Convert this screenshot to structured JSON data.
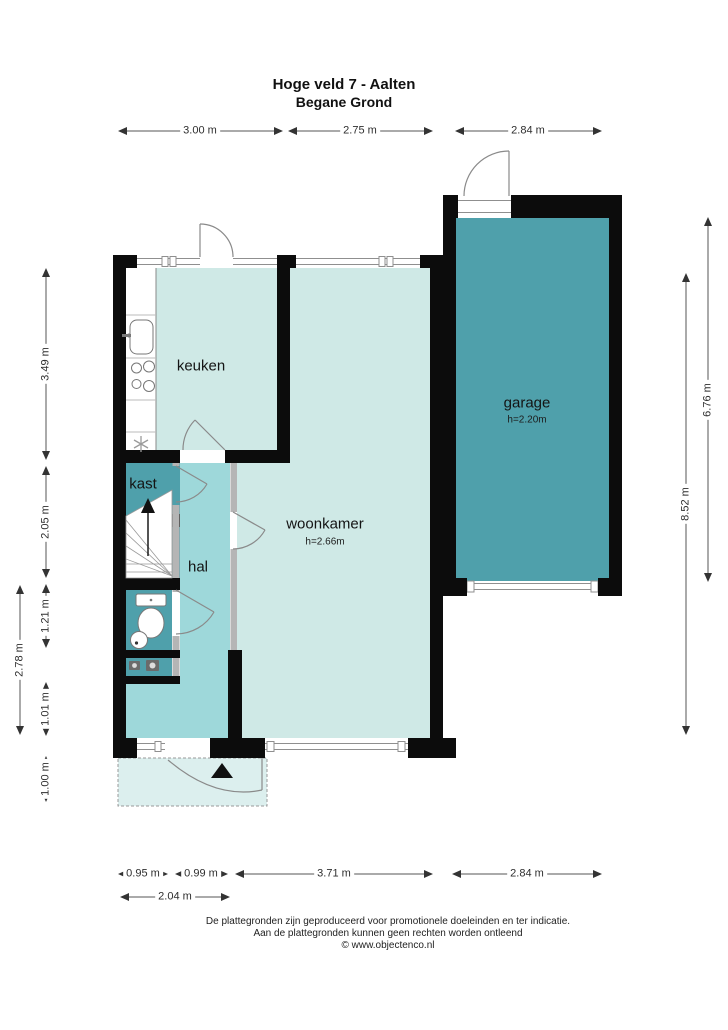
{
  "title": {
    "line1": "Hoge veld 7 - Aalten",
    "line2": "Begane Grond"
  },
  "rooms": {
    "keuken": {
      "label": "keuken"
    },
    "kast": {
      "label": "kast"
    },
    "hal": {
      "label": "hal"
    },
    "woonkamer": {
      "label": "woonkamer",
      "ceiling_height": "h=2.66m"
    },
    "garage": {
      "label": "garage",
      "ceiling_height": "h=2.20m"
    }
  },
  "dimensions": {
    "top": [
      "3.00 m",
      "2.75 m",
      "2.84 m"
    ],
    "bottom_row1": [
      "0.95 m",
      "0.99 m",
      "3.71 m",
      "2.84 m"
    ],
    "bottom_row2": "2.04 m",
    "left_inner": [
      "3.49 m",
      "2.05 m",
      "1.21 m",
      "1.01 m",
      "1.00 m"
    ],
    "left_outer": "2.78 m",
    "right_inner": "8.52 m",
    "right_outer": "6.76 m"
  },
  "footer": {
    "line1": "De plattegronden zijn geproduceerd voor promotionele doeleinden en ter indicatie.",
    "line2": "Aan de plattegronden kunnen geen rechten worden ontleend",
    "line3": "© www.objectenco.nl"
  },
  "colors": {
    "room_light": "#cfe9e6",
    "room_medium": "#9ed8da",
    "room_dark": "#4fa0ab",
    "porch": "#dcefee",
    "wall": "#0c0c0c"
  }
}
